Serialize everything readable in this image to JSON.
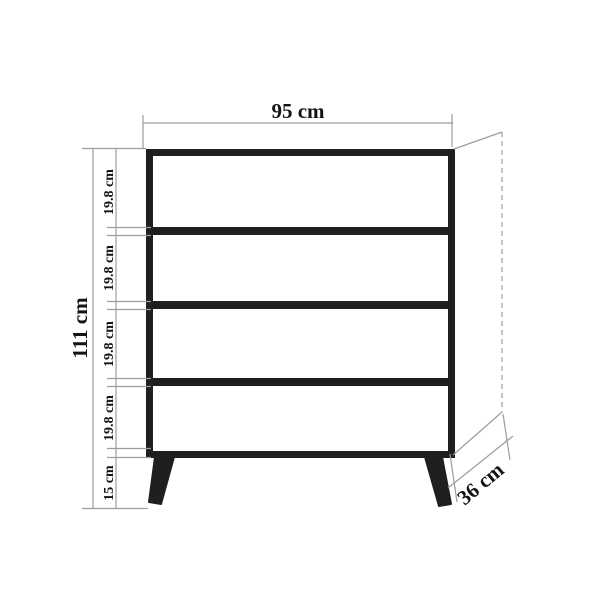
{
  "diagram": {
    "drawer_count": 4,
    "labels": {
      "width": "95 cm",
      "height": "111 cm",
      "depth": "36 cm",
      "leg_height": "15 cm",
      "drawer_heights": [
        "19.8 cm",
        "19.8 cm",
        "19.8 cm",
        "19.8 cm"
      ]
    }
  },
  "colors": {
    "outline": "#1f1f1f",
    "dimension": "#9d9d9d",
    "text": "#141414",
    "background": "#ffffff"
  }
}
